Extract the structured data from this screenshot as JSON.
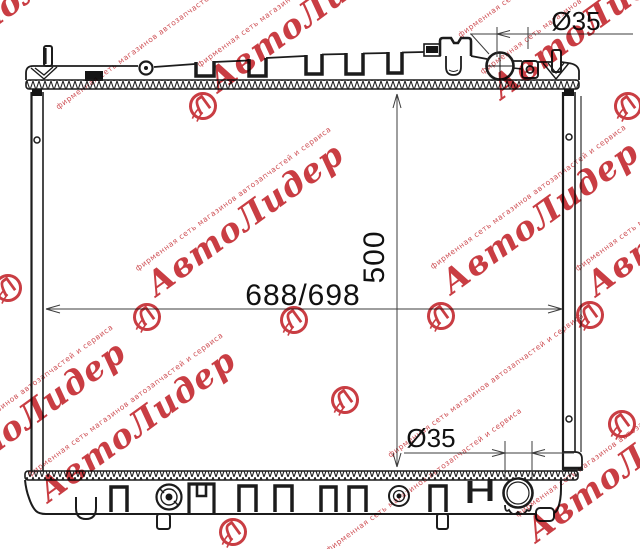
{
  "canvas": {
    "width": 640,
    "height": 549,
    "background": "#ffffff",
    "line_color": "#1c1c1c"
  },
  "drawing": {
    "subject": "radiator-outline-technical-drawing",
    "dimensions": {
      "width_label": "688/698",
      "height_label": "500",
      "top_port_diameter": "Ø35",
      "bottom_port_diameter": "Ø35"
    }
  },
  "watermark": {
    "brand": "АвтоЛидер",
    "tagline": "фирменная сеть магазинов автозапчастей и сервиса",
    "color": "#c22329"
  }
}
